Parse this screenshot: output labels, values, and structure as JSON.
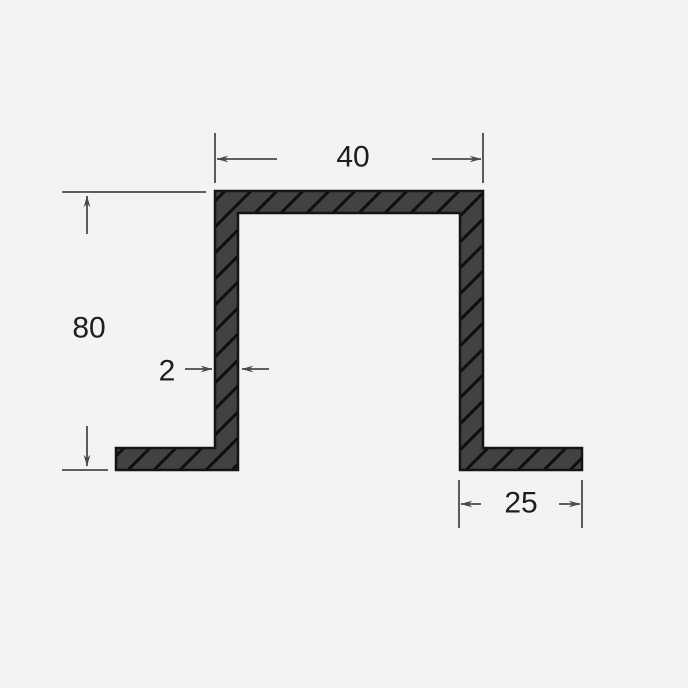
{
  "diagram": {
    "kind": "hat-channel-profile-cross-section",
    "labels": {
      "top_width": "40",
      "height": "80",
      "thickness": "2",
      "foot_width": "25"
    },
    "colors": {
      "background": "#f3f3f3",
      "profile_fill": "#424242",
      "profile_outline": "#141414",
      "hatch_line": "#0f0f0f",
      "dimension_line": "#4a4a4a",
      "label_text": "#1e1e1e"
    }
  }
}
